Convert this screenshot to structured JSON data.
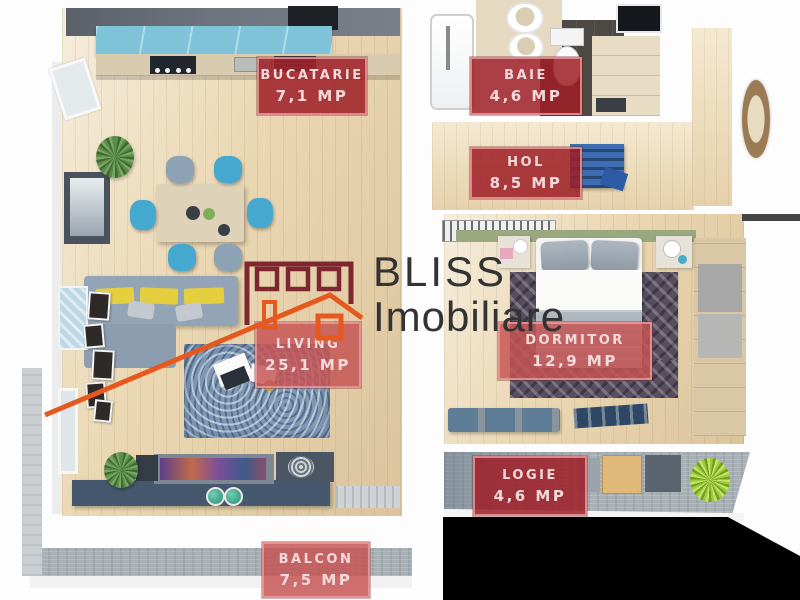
{
  "brand": {
    "name_line1": "BLISS",
    "name_line2": "Imobiliare",
    "logo_building_color": "#7e2730",
    "logo_house_color": "#e5581e",
    "text_color": "#333333"
  },
  "label_style": {
    "background_dark": "#9e1f26",
    "background_light": "#c65454",
    "border": "#e99e9e",
    "text": "#f4dada"
  },
  "rooms": [
    {
      "key": "bucatarie",
      "name": "BUCATARIE",
      "area": "7,1 MP"
    },
    {
      "key": "baie",
      "name": "BAIE",
      "area": "4,6 MP"
    },
    {
      "key": "hol",
      "name": "HOL",
      "area": "8,5 MP"
    },
    {
      "key": "living",
      "name": "LIVING",
      "area": "25,1 MP"
    },
    {
      "key": "dormitor",
      "name": "DORMITOR",
      "area": "12,9 MP"
    },
    {
      "key": "logie",
      "name": "LOGIE",
      "area": "4,6 MP"
    },
    {
      "key": "balcon",
      "name": "BALCON",
      "area": "7,5 MP"
    }
  ]
}
